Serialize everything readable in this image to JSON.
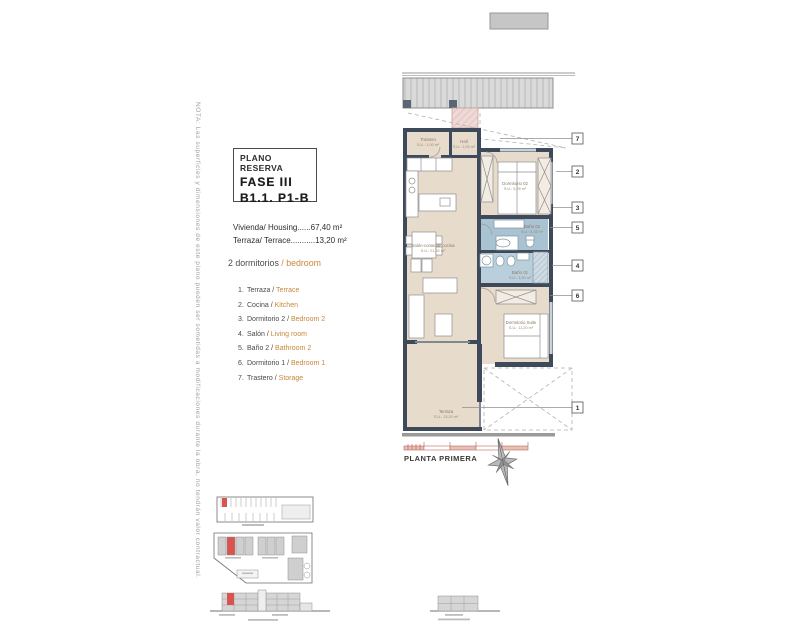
{
  "note": "NOTA: Las superficies y dimensiones de este plano pueden ser sometidas a modificaciones durante la obra, no tendrán valor contractual.",
  "title_block": {
    "line1": "PLANO RESERVA",
    "line2": "FASE III",
    "line3": "B1.1. P1-B"
  },
  "areas": {
    "housing": "Vivienda/ Housing......67,40 m²",
    "terrace": "Terraza/ Terrace...........13,20 m²"
  },
  "legend": {
    "heading_es": "2 dormitorios",
    "heading_sep": " / ",
    "heading_en": "bedroom",
    "items": [
      {
        "num": "1.",
        "es": "Terraza /",
        "en": " Terrace"
      },
      {
        "num": "2.",
        "es": "Cocina /",
        "en": " Kitchen"
      },
      {
        "num": "3.",
        "es": "Dormitorio 2 /",
        "en": " Bedroom 2"
      },
      {
        "num": "4.",
        "es": "Salón /",
        "en": " Living room"
      },
      {
        "num": "5.",
        "es": "Baño 2 /",
        "en": " Bathroom 2"
      },
      {
        "num": "6.",
        "es": "Dormitorio 1 /",
        "en": " Bedroom 1"
      },
      {
        "num": "7.",
        "es": "Trastero /",
        "en": " Storage"
      }
    ]
  },
  "plan": {
    "floor_name": "PLANTA PRIMERA",
    "rooms": {
      "trastero": {
        "name": "Trastero",
        "area": "S.U.: 1,00 m²"
      },
      "hall": {
        "name": "Hall",
        "area": "S.U.: 1,05 m²"
      },
      "dorm2": {
        "name": "Dormitorio 02",
        "area": "S.U.: 9,26 m²"
      },
      "bano2": {
        "name": "Baño 02",
        "area": "S.U.: 4,35 m²"
      },
      "bano1": {
        "name": "Baño 01",
        "area": "S.U.: 3,60 m²"
      },
      "salon": {
        "name": "Salón-comedor-cocina",
        "area": "S.U.: 21,92 m²"
      },
      "suite": {
        "name": "Dormitorio Suite",
        "area": "S.U.: 11,20 m²"
      },
      "terraza": {
        "name": "Terraza",
        "area": "S.U.: 13,20 m²"
      }
    },
    "callouts": {
      "c7": "7",
      "c2": "2",
      "c3": "3",
      "c5": "5",
      "c4": "4",
      "c6": "6",
      "c1": "1"
    }
  },
  "colors": {
    "wall": "#3e4a59",
    "floor": "#e7dbcc",
    "bathroom": "#a9c3d3",
    "accent_red": "#d9534f",
    "legend_orange": "#c8873a",
    "band_gray": "#d8d8d8",
    "note_gray": "#9aa69e"
  }
}
